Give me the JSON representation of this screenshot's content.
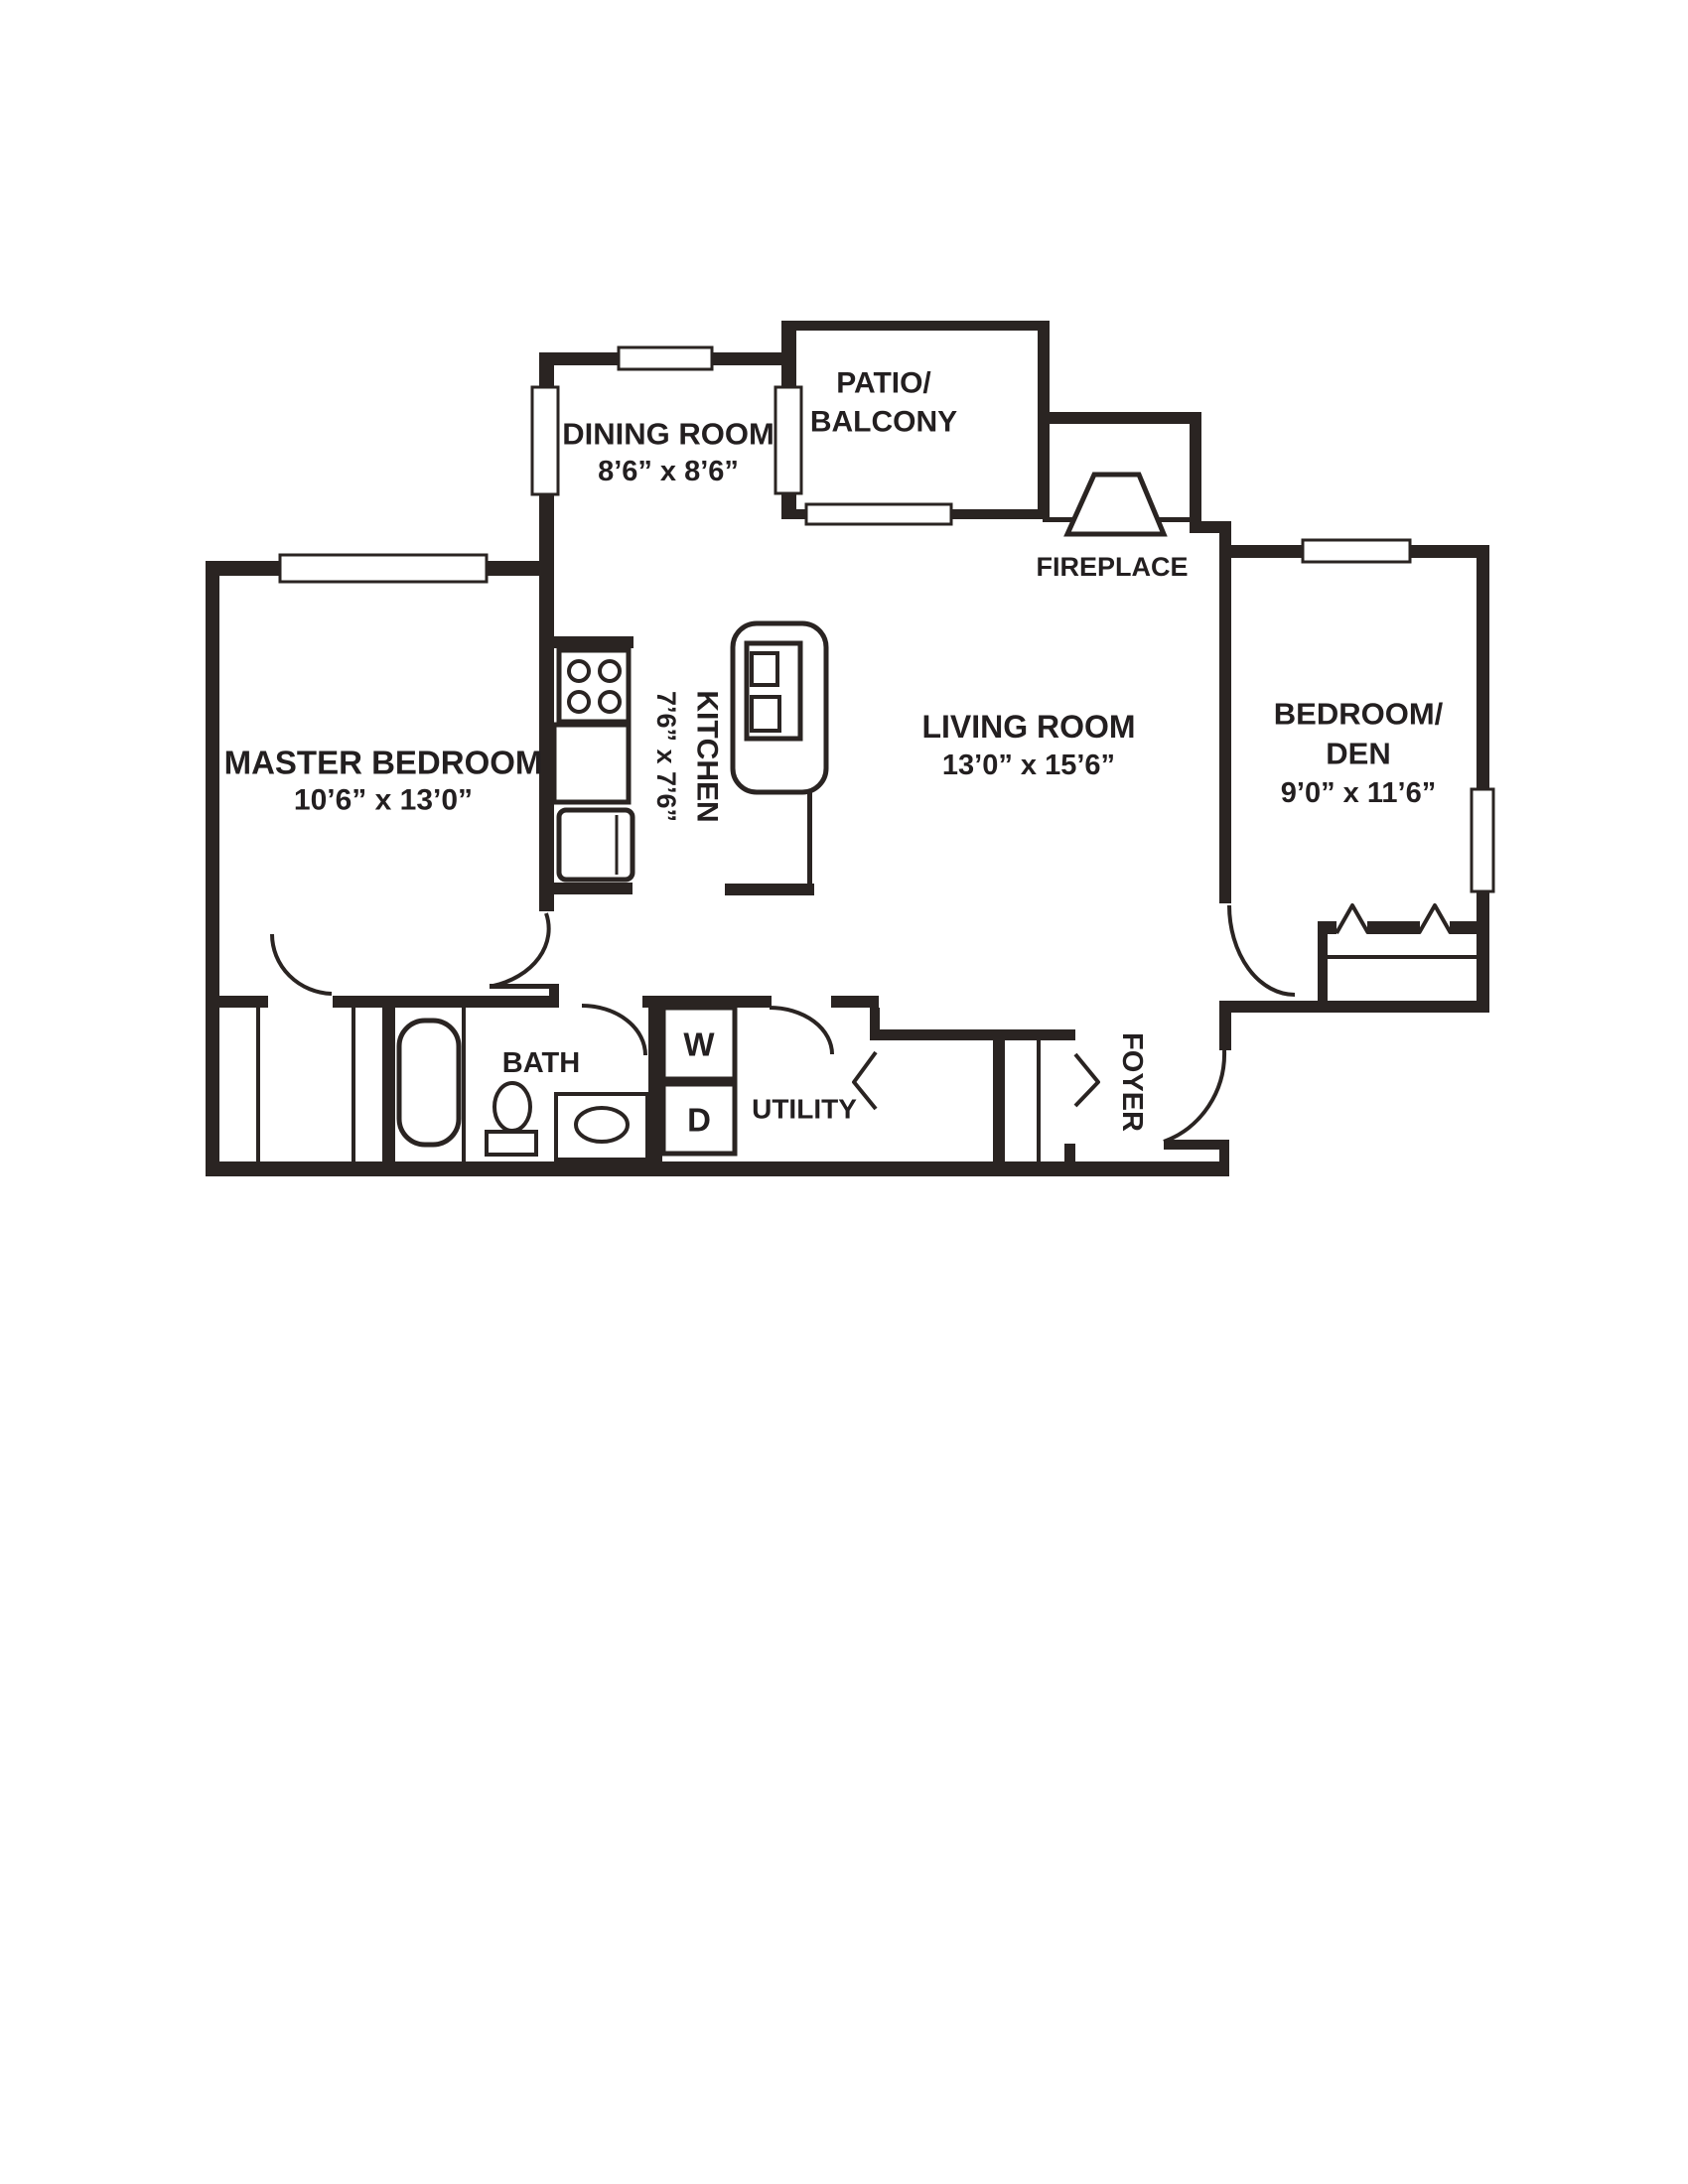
{
  "type": "apartment-floor-plan",
  "colors": {
    "wall": "#2a2422",
    "text": "#231f20",
    "background": "#ffffff"
  },
  "rooms": {
    "dining_room": {
      "name": "DINING ROOM",
      "dims": "8’6” x 8’6”"
    },
    "patio_balcony": {
      "line1": "PATIO/",
      "line2": "BALCONY"
    },
    "fireplace": {
      "name": "FIREPLACE"
    },
    "master_bedroom": {
      "name": "MASTER BEDROOM",
      "dims": "10’6” x 13’0”"
    },
    "kitchen": {
      "name": "KITCHEN",
      "dims": "7’6” x 7’6”"
    },
    "living_room": {
      "name": "LIVING ROOM",
      "dims": "13’0” x 15’6”"
    },
    "bedroom_den": {
      "line1": "BEDROOM/",
      "line2": "DEN",
      "dims": "9’0” x 11’6”"
    },
    "bath": {
      "name": "BATH"
    },
    "utility": {
      "name": "UTILITY",
      "washer": "W",
      "dryer": "D"
    },
    "foyer": {
      "name": "FOYER"
    }
  }
}
